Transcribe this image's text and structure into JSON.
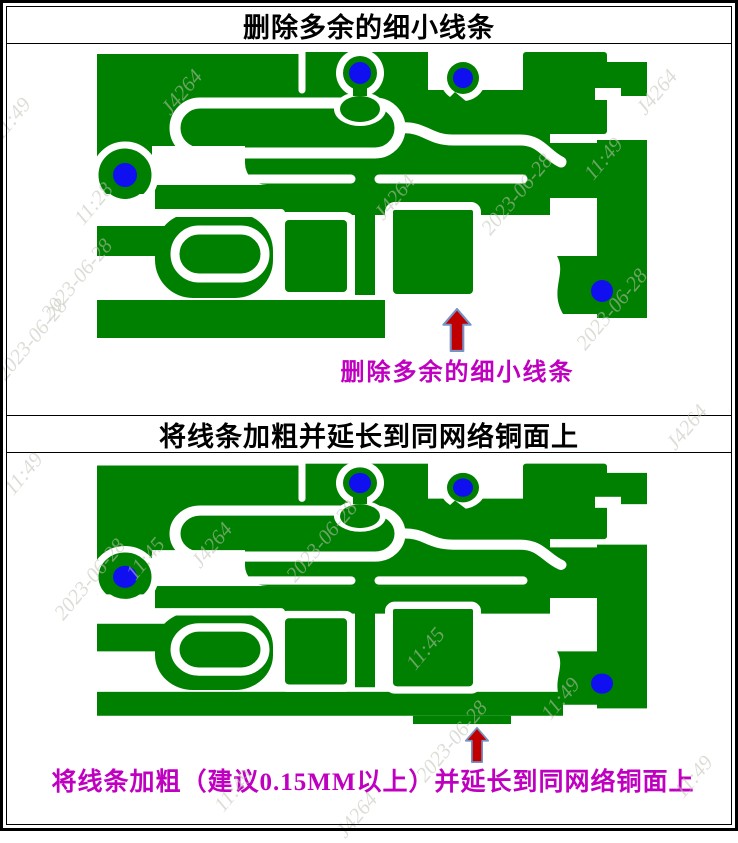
{
  "panels": [
    {
      "title": "删除多余的细小线条",
      "annotation": "删除多余的细小线条"
    },
    {
      "title": "将线条加粗并延长到同网络铜面上",
      "annotation": "将线条加粗（建议0.15MM以上）并延长到同网络铜面上"
    }
  ],
  "colors": {
    "copper_green": "#008000",
    "via_blue": "#0f0ff0",
    "arrow_red": "#c00000",
    "arrow_outline": "#7593c6",
    "annotation_magenta": "#c000c0",
    "watermark_gray": "#c3c3b8"
  },
  "watermarks": {
    "items": [
      {
        "text": "11:49",
        "x": 6,
        "y": 120
      },
      {
        "text": "11:28",
        "x": 88,
        "y": 205
      },
      {
        "text": "2023-06-28",
        "x": 10,
        "y": 360
      },
      {
        "text": "2023-06-28",
        "x": 55,
        "y": 300
      },
      {
        "text": "J4264",
        "x": 175,
        "y": 95
      },
      {
        "text": "J4264",
        "x": 388,
        "y": 200
      },
      {
        "text": "2023-06-28",
        "x": 495,
        "y": 215
      },
      {
        "text": "11:49",
        "x": 598,
        "y": 160
      },
      {
        "text": "J4264",
        "x": 650,
        "y": 95
      },
      {
        "text": "2023-06-28",
        "x": 590,
        "y": 330
      },
      {
        "text": "J4264",
        "x": 680,
        "y": 430
      },
      {
        "text": "11:49",
        "x": 18,
        "y": 475
      },
      {
        "text": "2023-06-28",
        "x": 68,
        "y": 600
      },
      {
        "text": "11:45",
        "x": 140,
        "y": 560
      },
      {
        "text": "J4264",
        "x": 205,
        "y": 548
      },
      {
        "text": "2023-06-28",
        "x": 300,
        "y": 562
      },
      {
        "text": "11:45",
        "x": 420,
        "y": 650
      },
      {
        "text": "2023-06-28",
        "x": 430,
        "y": 762
      },
      {
        "text": "11:49",
        "x": 555,
        "y": 700
      },
      {
        "text": "11:49",
        "x": 688,
        "y": 778
      },
      {
        "text": "J4264",
        "x": 350,
        "y": 818
      },
      {
        "text": "11:49",
        "x": 228,
        "y": 792
      }
    ]
  }
}
